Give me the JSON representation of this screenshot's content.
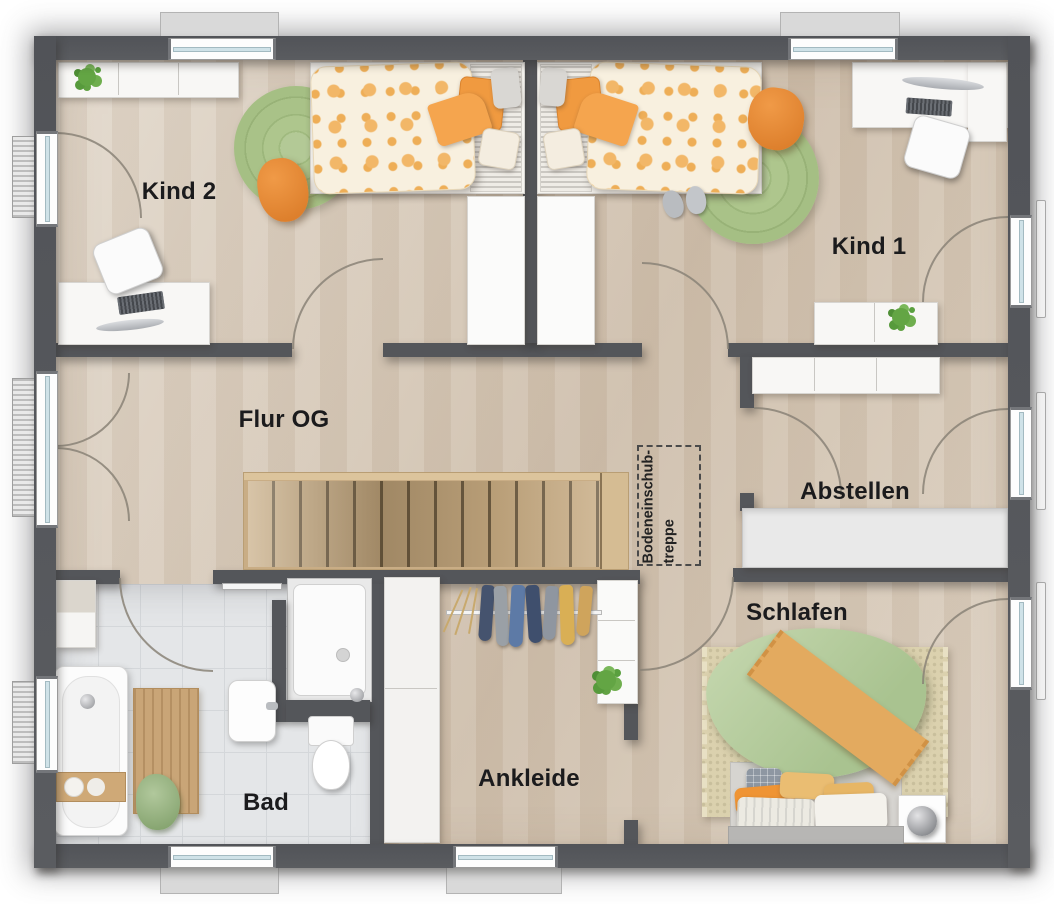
{
  "floorplan": {
    "title": "Obergeschoss Grundriss",
    "rooms": [
      {
        "id": "kind-2",
        "label": "Kind 2"
      },
      {
        "id": "kind-1",
        "label": "Kind 1"
      },
      {
        "id": "flur-og",
        "label": "Flur OG"
      },
      {
        "id": "abstellen",
        "label": "Abstellen"
      },
      {
        "id": "schlafen",
        "label": "Schlafen"
      },
      {
        "id": "ankleide",
        "label": "Ankleide"
      },
      {
        "id": "bad",
        "label": "Bad"
      }
    ],
    "loft_hatch_label": {
      "line1": "Bodeneinschub-",
      "line2": "treppe"
    },
    "colors": {
      "wall": "#54565a",
      "floor_wood": "#d9ccbb",
      "bath_tile": "#e4e6e8",
      "stair_wood": "#c7ab82",
      "rug_green": "#a9c287",
      "duvet_green": "#bcd0a5",
      "accent_orange": "#ef9a40",
      "rug_beige": "#dbd1ae"
    }
  }
}
